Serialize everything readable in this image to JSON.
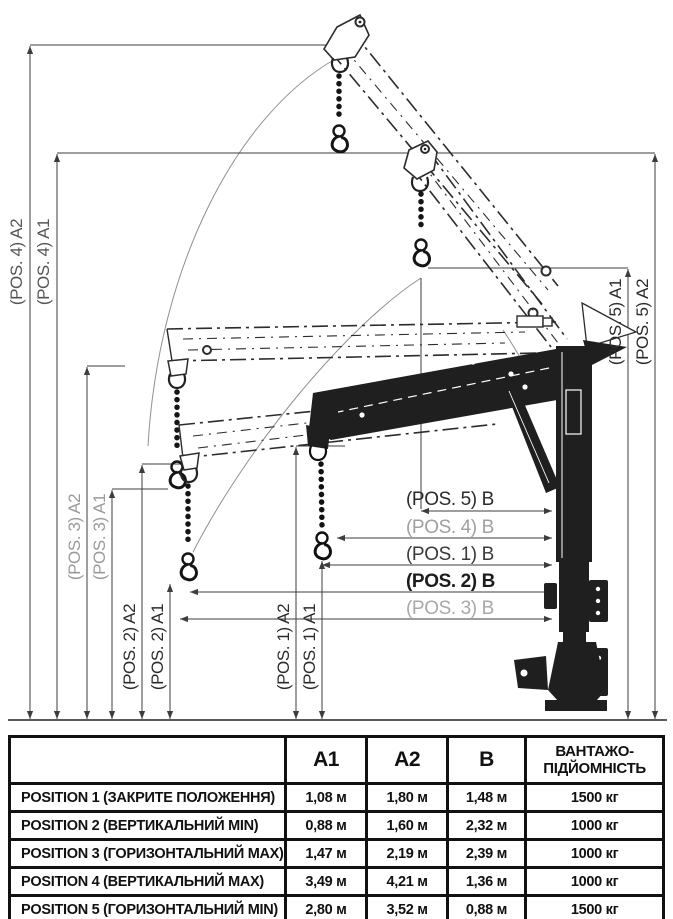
{
  "diagram": {
    "dim_labels": {
      "pos4_a2": "(POS. 4) A2",
      "pos4_a1": "(POS. 4) A1",
      "pos3_a2": "(POS. 3) A2",
      "pos3_a1": "(POS. 3) A1",
      "pos2_a2": "(POS. 2) A2",
      "pos2_a1": "(POS. 2) A1",
      "pos1_a2": "(POS. 1) A2",
      "pos1_a1": "(POS. 1) A1",
      "pos5_a1": "(POS. 5) A1",
      "pos5_a2": "(POS. 5) A2",
      "pos5_b": "(POS. 5) B",
      "pos4_b": "(POS. 4) B",
      "pos1_b": "(POS. 1) B",
      "pos2_b": "(POS. 2) B",
      "pos3_b": "(POS. 3) B"
    },
    "colors": {
      "line": "#3d3d3d",
      "label_dark": "#2b2b2b",
      "label_gray": "#9a9a9a",
      "crane_fill": "#1f1f1f",
      "arc": "#909090"
    }
  },
  "table": {
    "columns": [
      "",
      "A1",
      "A2",
      "B"
    ],
    "capacity_header": {
      "line1": "ВАНТАЖО-",
      "line2": "ПІДЙОМНІСТЬ"
    },
    "rows": [
      {
        "label": "POSITION 1 (ЗАКРИТЕ ПОЛОЖЕННЯ)",
        "a1": "1,08 м",
        "a2": "1,80 м",
        "b": "1,48 м",
        "capacity": "1500 кг"
      },
      {
        "label": "POSITION 2 (ВЕРТИКАЛЬНИЙ MIN)",
        "a1": "0,88 м",
        "a2": "1,60 м",
        "b": "2,32 м",
        "capacity": "1000 кг"
      },
      {
        "label": "POSITION 3 (ГОРИЗОНТАЛЬНИЙ MAX)",
        "a1": "1,47 м",
        "a2": "2,19 м",
        "b": "2,39 м",
        "capacity": "1000 кг"
      },
      {
        "label": "POSITION 4 (ВЕРТИКАЛЬНИЙ MAX)",
        "a1": "3,49 м",
        "a2": "4,21 м",
        "b": "1,36 м",
        "capacity": "1000 кг"
      },
      {
        "label": "POSITION 5 (ГОРИЗОНТАЛЬНИЙ MIN)",
        "a1": "2,80 м",
        "a2": "3,52 м",
        "b": "0,88 м",
        "capacity": "1500 кг"
      }
    ]
  },
  "chart_data": {
    "type": "table",
    "title": "Crane positions dimensions and load capacity",
    "categories": [
      "POSITION 1",
      "POSITION 2",
      "POSITION 3",
      "POSITION 4",
      "POSITION 5"
    ],
    "series": [
      {
        "name": "A1 (м)",
        "values": [
          1.08,
          0.88,
          1.47,
          3.49,
          2.8
        ]
      },
      {
        "name": "A2 (м)",
        "values": [
          1.8,
          1.6,
          2.19,
          4.21,
          3.52
        ]
      },
      {
        "name": "B (м)",
        "values": [
          1.48,
          2.32,
          2.39,
          1.36,
          0.88
        ]
      },
      {
        "name": "Вантажопідйомність (кг)",
        "values": [
          1500,
          1000,
          1000,
          1000,
          1500
        ]
      }
    ]
  }
}
